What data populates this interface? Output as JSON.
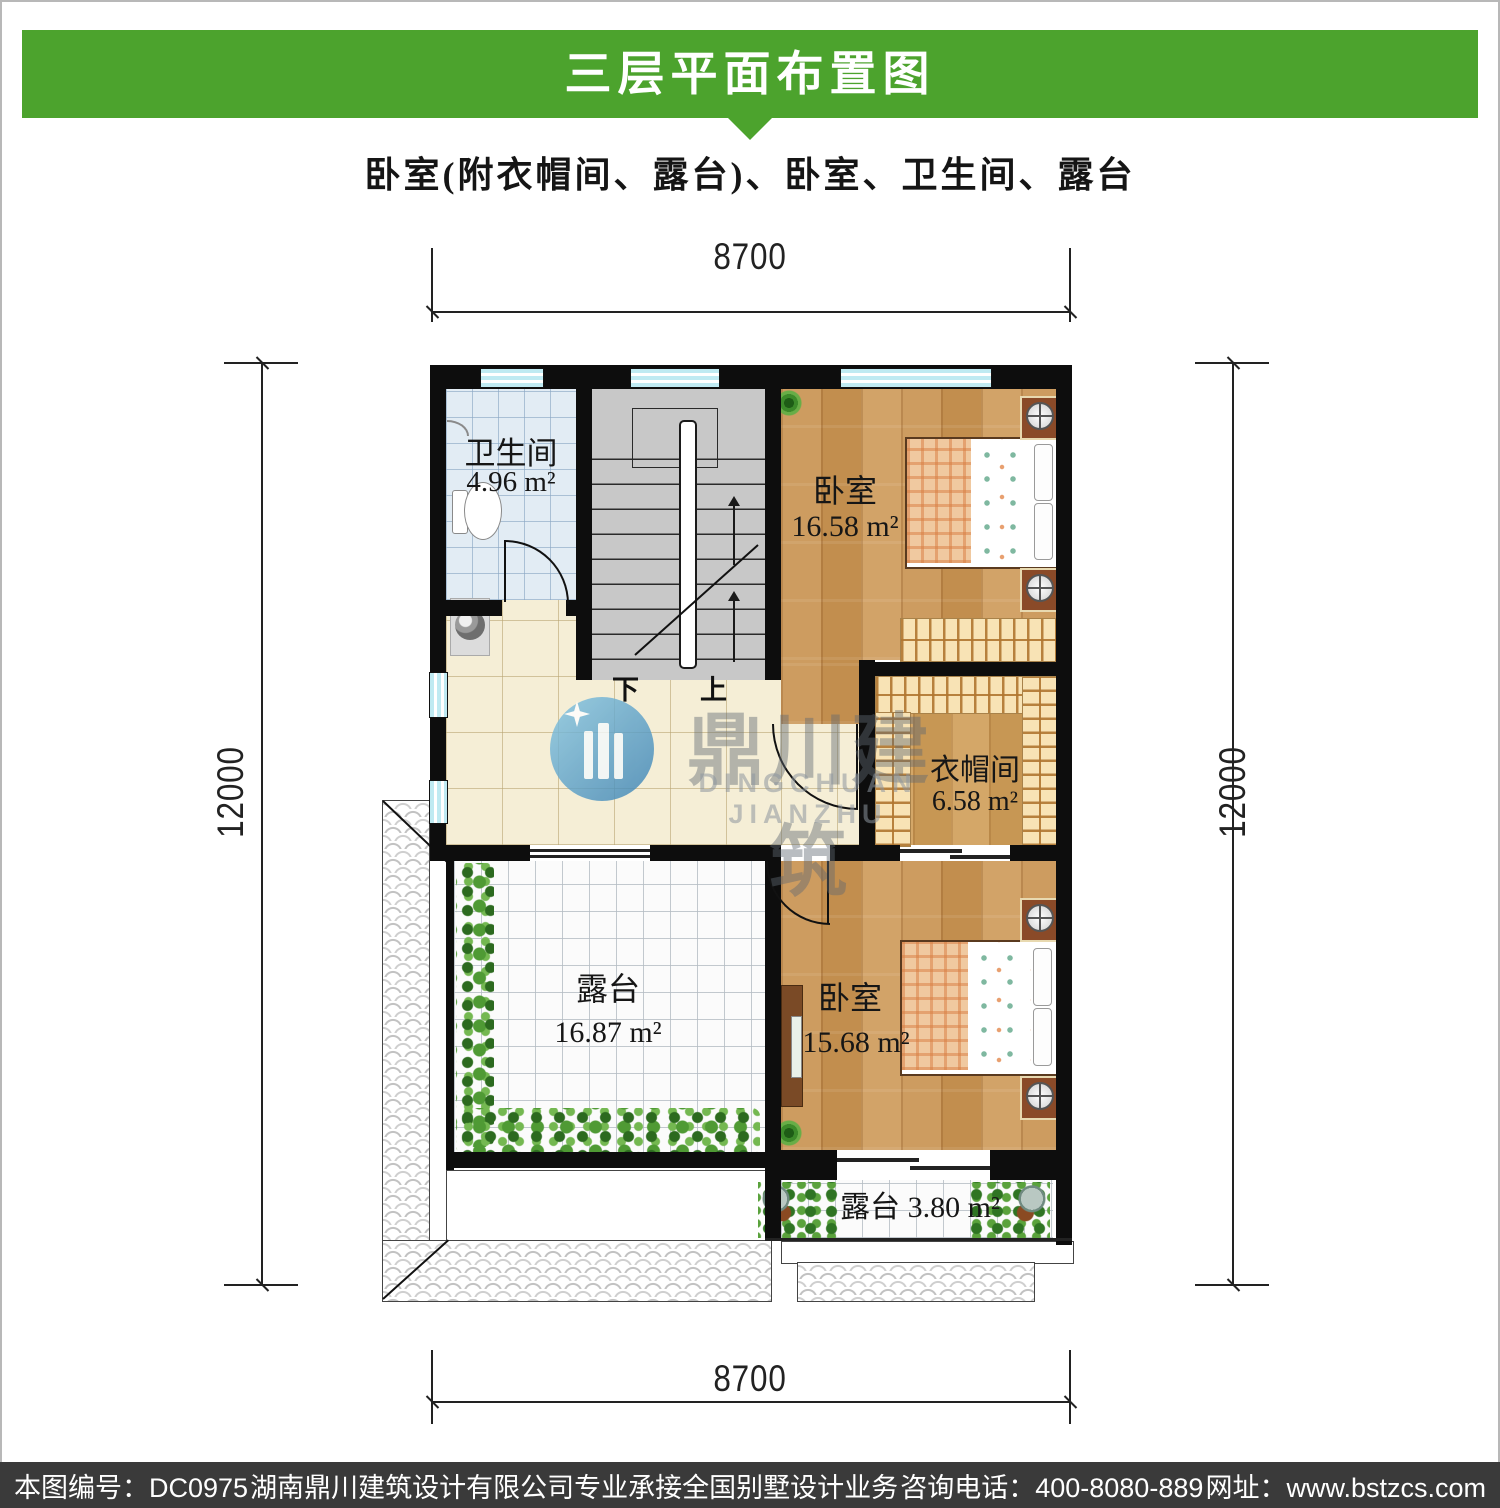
{
  "header": {
    "title": "三层平面布置图",
    "subtitle": "卧室(附衣帽间、露台)、卧室、卫生间、露台",
    "banner_color": "#4ca32d"
  },
  "dimensions": {
    "top": "8700",
    "bottom": "8700",
    "left": "12000",
    "right": "12000"
  },
  "rooms": {
    "bathroom": {
      "name": "卫生间",
      "area": "4.96 m²"
    },
    "bedroom_top": {
      "name": "卧室",
      "area": "16.58 m²"
    },
    "closet": {
      "name": "衣帽间",
      "area": "6.58 m²"
    },
    "terrace": {
      "name": "露台",
      "area": "16.87 m²"
    },
    "bedroom_bottom": {
      "name": "卧室",
      "area": "15.68 m²"
    },
    "terrace_small": {
      "name": "露台",
      "area": "3.80 m²"
    }
  },
  "stairs": {
    "down_label": "下",
    "up_label": "上"
  },
  "watermark": {
    "name_cn": "鼎川建筑",
    "name_en": "DINGCHUAN JIANZHU",
    "logo_color": "#4d94c2"
  },
  "footer": {
    "bar_color": "#3a3a3a",
    "sheet_no": "本图编号：DC0975",
    "company": "湖南鼎川建筑设计有限公司专业承接全国别墅设计业务",
    "phone": "咨询电话：400-8080-889",
    "website": "网址：www.bstzcs.com"
  }
}
